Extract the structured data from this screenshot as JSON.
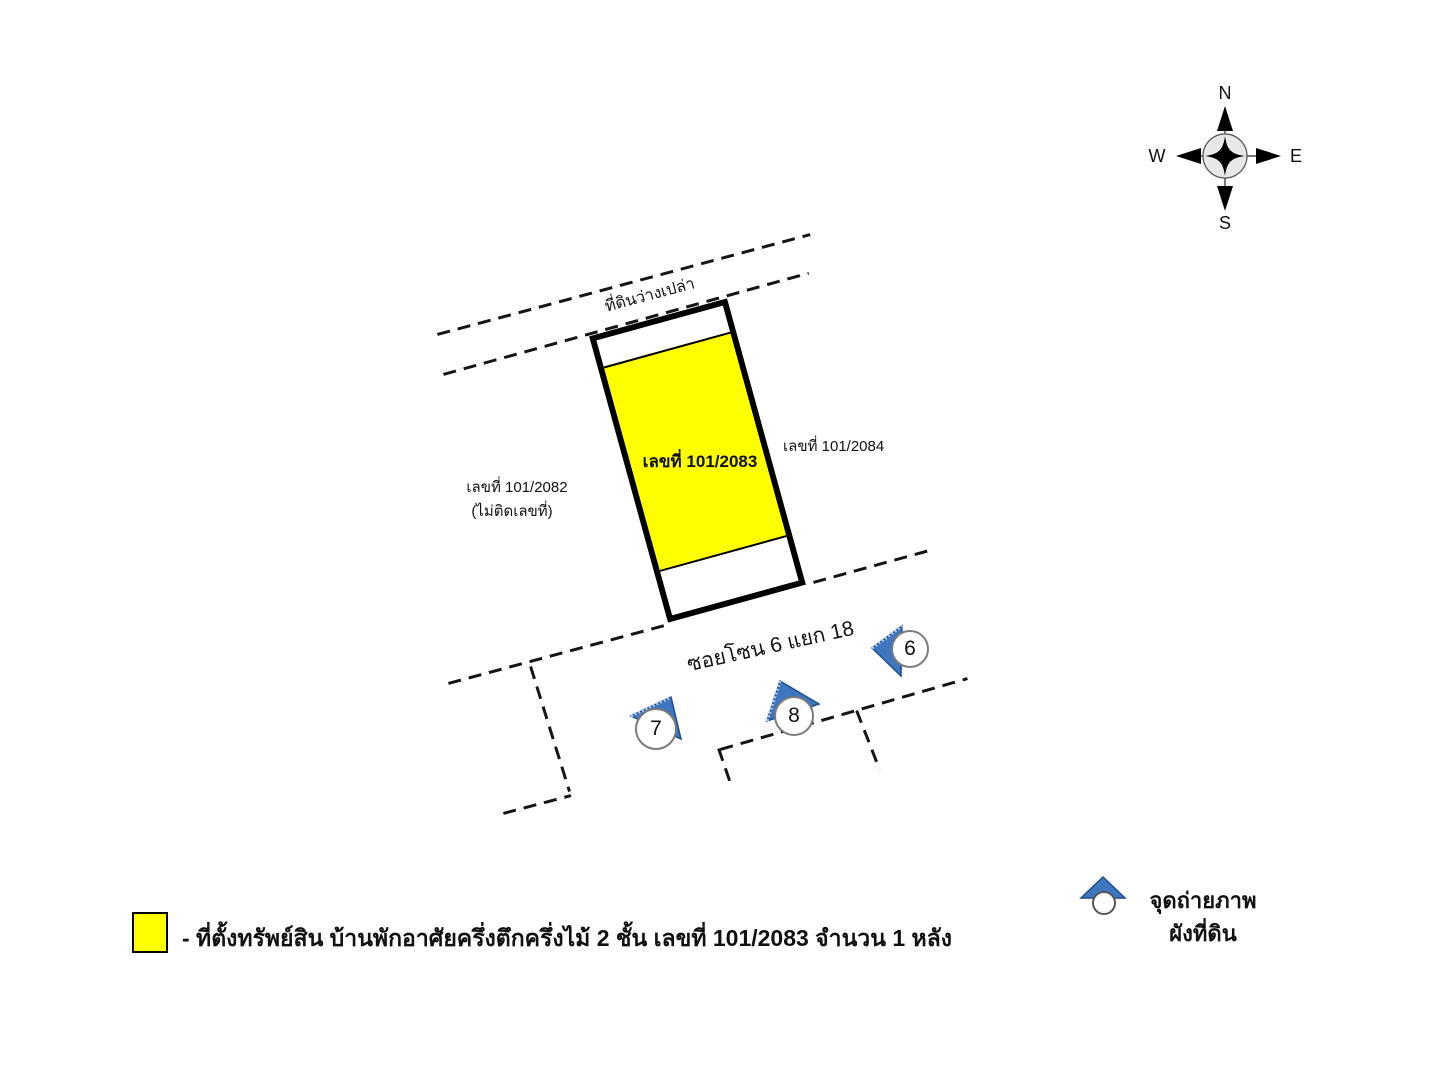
{
  "compass": {
    "north": "N",
    "east": "E",
    "south": "S",
    "west": "W"
  },
  "map": {
    "vacant_land_label": "ที่ดินว่างเปล่า",
    "subject_parcel_label": "เลขที่ 101/2083",
    "right_parcel_label": "เลขที่ 101/2084",
    "left_parcel_label_line1": "เลขที่ 101/2082",
    "left_parcel_label_line2": "(ไม่ติดเลขที่)",
    "road_label": "ซอยโซน 6 แยก 18",
    "camera_markers": [
      {
        "label": "6"
      },
      {
        "label": "7"
      },
      {
        "label": "8"
      }
    ]
  },
  "legend": {
    "property_text": "- ที่ตั้งทรัพย์สิน บ้านพักอาศัยครึ่งตึกครึ่งไม้ 2 ชั้น เลขที่ 101/2083 จำนวน 1 หลัง",
    "photo_point_line1": "จุดถ่ายภาพ",
    "photo_point_line2": "ผังที่ดิน"
  },
  "colors": {
    "parcel_fill": "#ffff00",
    "marker_blue": "#3e76c0",
    "line_black": "#151515"
  }
}
